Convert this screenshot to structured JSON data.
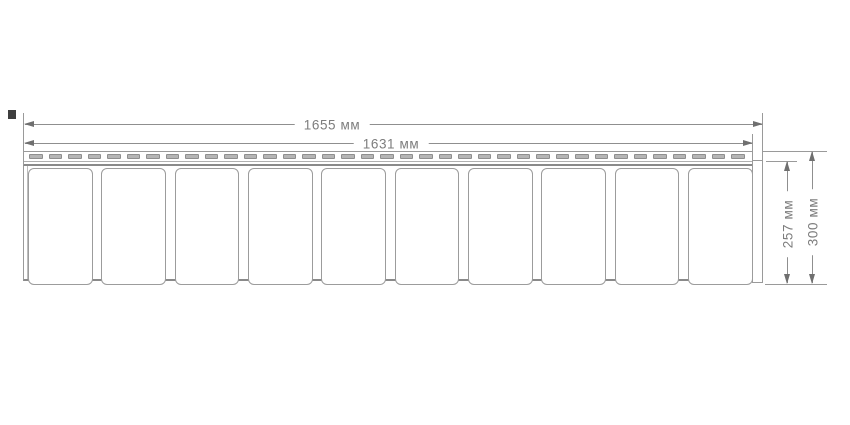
{
  "diagram": {
    "kind": "technical-dimension-drawing",
    "subject": "siding-panel-profile",
    "background_color": "#ffffff",
    "line_color": "#9a9a9a",
    "accent_line_color": "#8a8a8a",
    "text_color": "#7d7d7d",
    "dimensions": {
      "total_width": {
        "value": 1655,
        "unit": "мм",
        "label": "1655 мм"
      },
      "panel_width": {
        "value": 1631,
        "unit": "мм",
        "label": "1631 мм"
      },
      "body_height": {
        "value": 257,
        "unit": "мм",
        "label": "257 мм"
      },
      "total_height": {
        "value": 300,
        "unit": "мм",
        "label": "300 мм"
      }
    },
    "panel": {
      "tile_count": 10,
      "nail_slot_count": 37,
      "tile_fill": "#ffffff",
      "slot_fill": "#b5b5b5"
    }
  }
}
